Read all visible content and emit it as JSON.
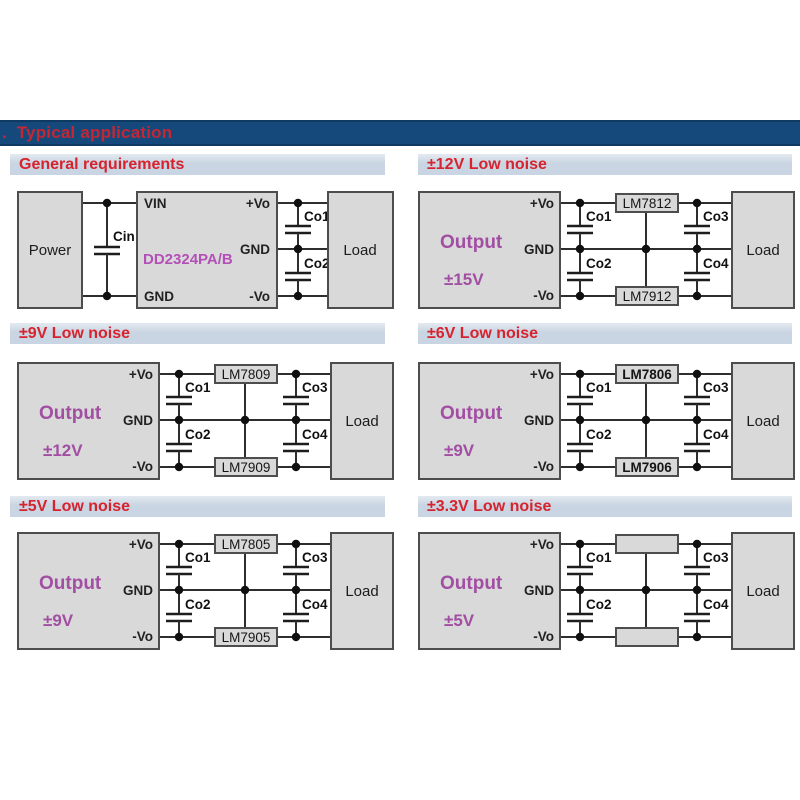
{
  "title_bar": {
    "prefix": ".",
    "title": "Typical application"
  },
  "colors": {
    "title_bar_bg": "#15497b",
    "section_header_bg": "#c9d5e2",
    "heading_red": "#d6232e",
    "output_purple": "#a14ea3",
    "part_magenta": "#b44fb8",
    "box_fill": "#d9d9d9",
    "box_border": "#4d4d4d",
    "wire": "#2e2e2e"
  },
  "sections": {
    "general": {
      "header": "General requirements",
      "source": "Power",
      "input_cap": "Cin",
      "part": "DD2324PA/B",
      "pins_left": [
        "VIN",
        "GND"
      ],
      "pins_right": [
        "+Vo",
        "GND",
        "-Vo"
      ],
      "output_caps": [
        "Co1",
        "Co2"
      ],
      "load": "Load"
    },
    "ln12v": {
      "header": "±12V Low noise",
      "output_label": "Output",
      "output_voltage": "±15V",
      "pins": [
        "+Vo",
        "GND",
        "-Vo"
      ],
      "caps": [
        "Co1",
        "Co2",
        "Co3",
        "Co4"
      ],
      "reg_top": "LM7812",
      "reg_bottom": "LM7912",
      "load": "Load"
    },
    "ln9v": {
      "header": "±9V Low noise",
      "output_label": "Output",
      "output_voltage": "±12V",
      "pins": [
        "+Vo",
        "GND",
        "-Vo"
      ],
      "caps": [
        "Co1",
        "Co2",
        "Co3",
        "Co4"
      ],
      "reg_top": "LM7809",
      "reg_bottom": "LM7909",
      "load": "Load"
    },
    "ln6v": {
      "header": "±6V Low noise",
      "output_label": "Output",
      "output_voltage": "±9V",
      "pins": [
        "+Vo",
        "GND",
        "-Vo"
      ],
      "caps": [
        "Co1",
        "Co2",
        "Co3",
        "Co4"
      ],
      "reg_top": "LM7806",
      "reg_bottom": "LM7906",
      "load": "Load"
    },
    "ln5v": {
      "header": "±5V Low noise",
      "output_label": "Output",
      "output_voltage": "±9V",
      "pins": [
        "+Vo",
        "GND",
        "-Vo"
      ],
      "caps": [
        "Co1",
        "Co2",
        "Co3",
        "Co4"
      ],
      "reg_top": "LM7805",
      "reg_bottom": "LM7905",
      "load": "Load"
    },
    "ln3v3": {
      "header": "±3.3V Low noise",
      "output_label": "Output",
      "output_voltage": "±5V",
      "pins": [
        "+Vo",
        "GND",
        "-Vo"
      ],
      "caps": [
        "Co1",
        "Co2",
        "Co3",
        "Co4"
      ],
      "reg_top": "",
      "reg_bottom": "",
      "load": "Load"
    }
  }
}
